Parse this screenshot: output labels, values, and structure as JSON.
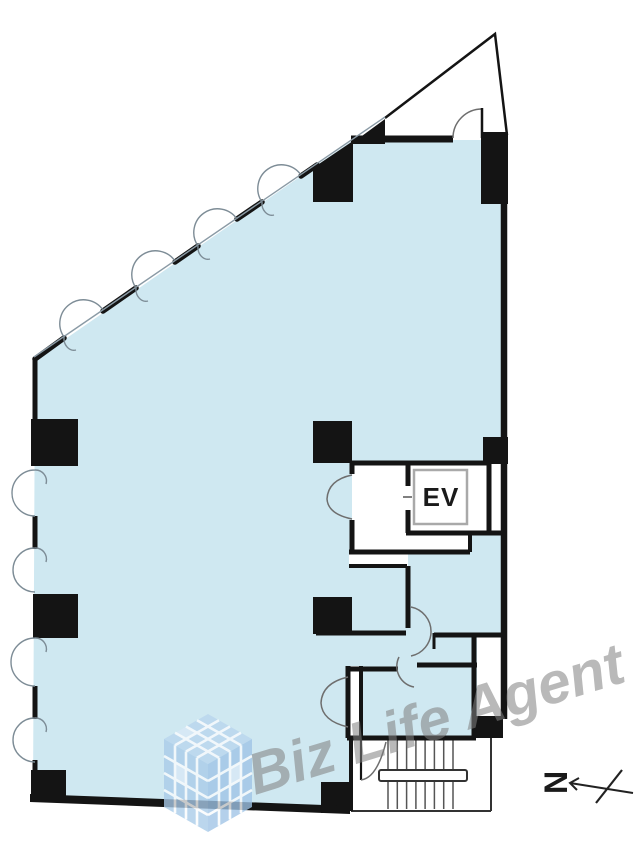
{
  "plan": {
    "title": "building-floor-plan",
    "labels": {
      "elevator": "EV"
    },
    "compass": {
      "letter": "N"
    },
    "watermark": {
      "text": "Biz Life Agent"
    },
    "palette": {
      "floor_fill": "#cfe8f1",
      "wall": "#141414",
      "thin_outline": "#333333",
      "arc_stroke": "#6e6e6e",
      "window_stroke": "#7d8c96",
      "watermark_gray": "#808080",
      "logo_blue_top": "#b9d5ee",
      "logo_blue_left": "#a9cbe9",
      "logo_blue_right": "#9fc4e6",
      "ev_box_border": "#a9a9a9"
    },
    "features": {
      "diagonal_windows": 4,
      "left_wall_windows": 4,
      "stair_treads": 8,
      "columns": 11
    }
  }
}
